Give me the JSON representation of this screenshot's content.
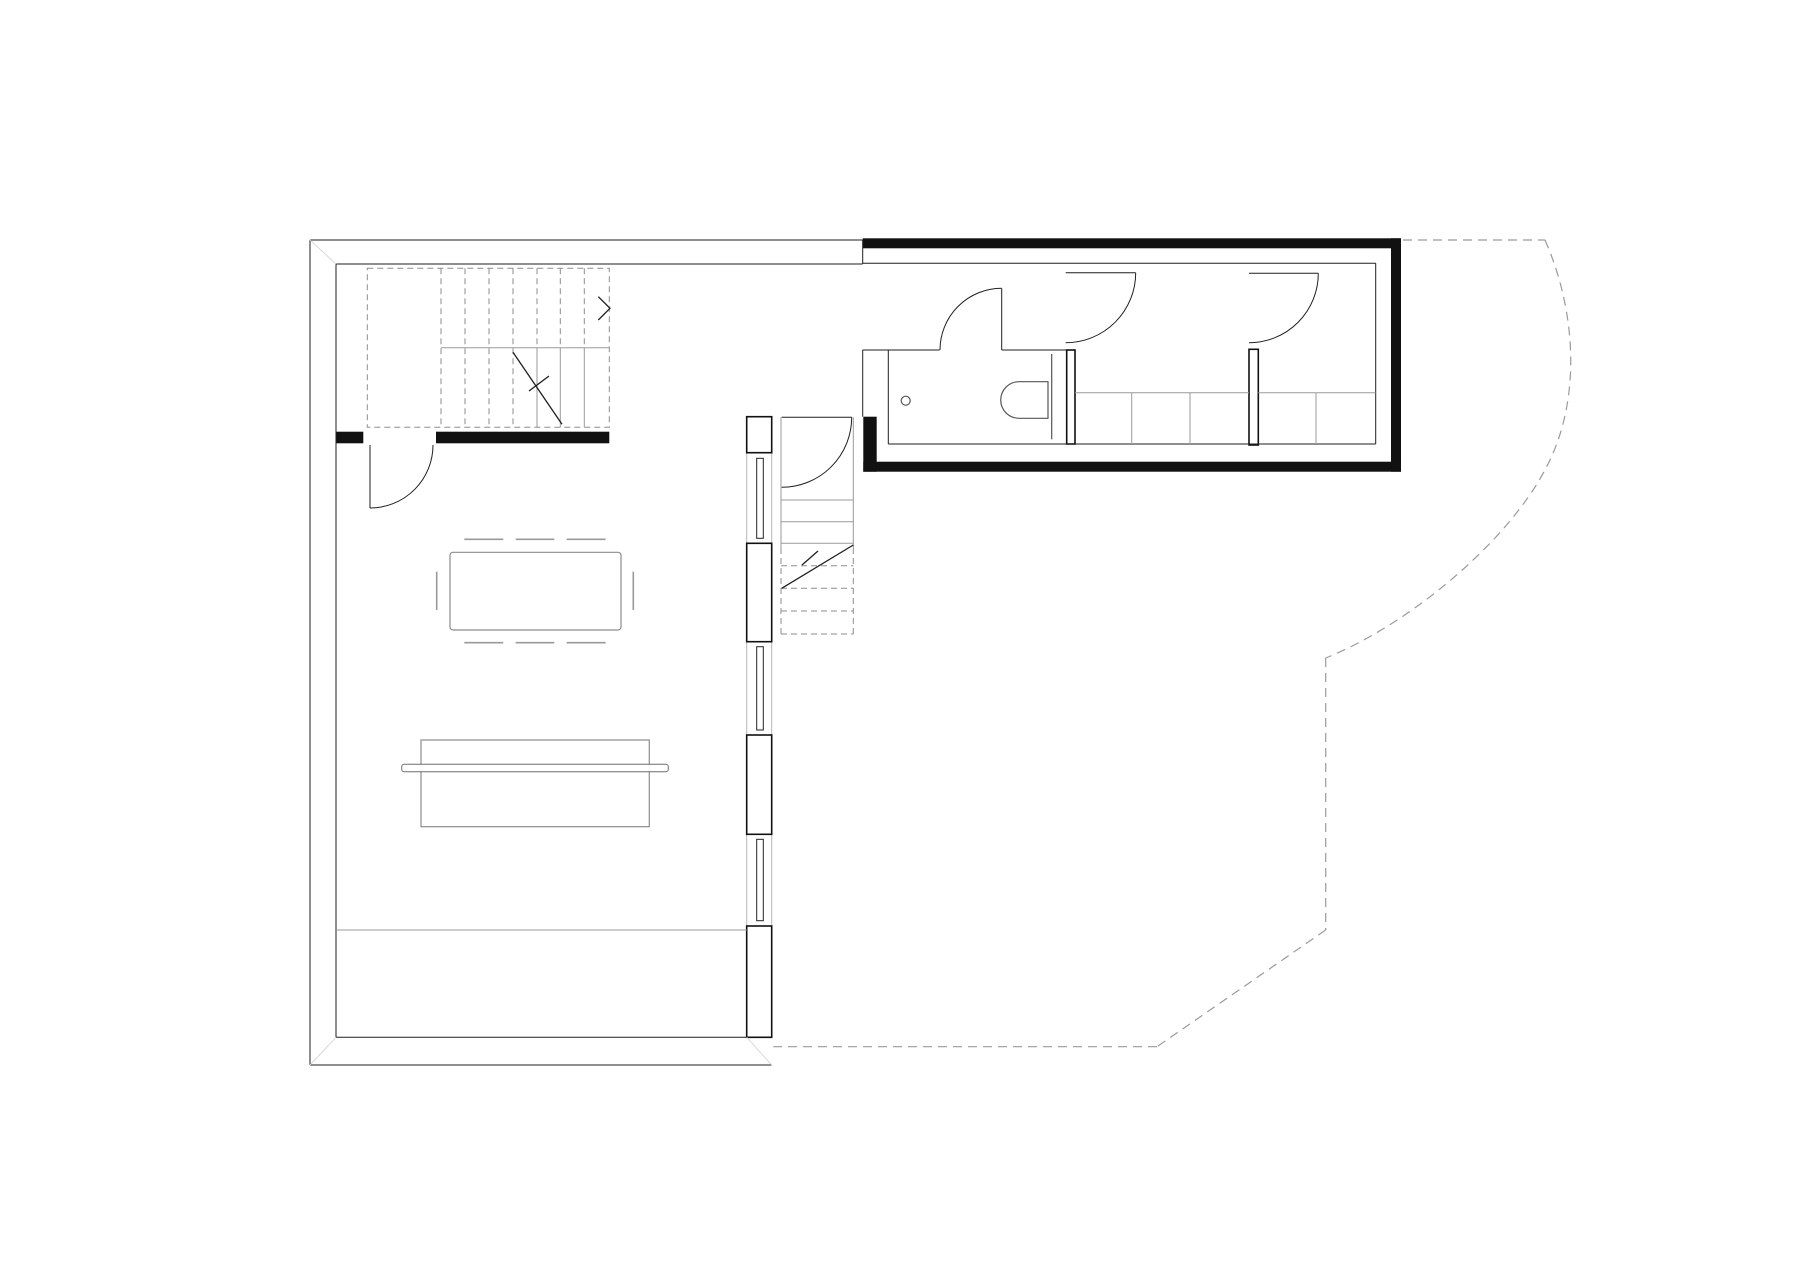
{
  "meta": {
    "title": "architectural-floor-plan",
    "canvas": {
      "w": 1800,
      "h": 1273
    },
    "background": "#ffffff"
  },
  "styles": {
    "wall": {
      "stroke": "#1f1f1f",
      "width": 1,
      "fill": "none"
    },
    "wallbold": {
      "stroke": "#111111",
      "width": 1.6,
      "fill": "#ffffff"
    },
    "black": {
      "stroke": "none",
      "width": 0,
      "fill": "#111111"
    },
    "band": {
      "stroke": "#b5b5b5",
      "width": 1,
      "fill": "none"
    },
    "glz": {
      "stroke": "#222222",
      "width": 1,
      "fill": "#ffffff"
    },
    "gray": {
      "stroke": "#9a9a9a",
      "width": 1,
      "fill": "none"
    },
    "graydash": {
      "stroke": "#8d8d8d",
      "width": 1,
      "fill": "none",
      "dash": "6,4"
    },
    "furn": {
      "stroke": "#8c8c8c",
      "width": 1.2,
      "fill": "#ffffff"
    },
    "furnbar": {
      "stroke": "#6f6f6f",
      "width": 1,
      "fill": "#ffffff"
    },
    "fix": {
      "stroke": "#555555",
      "width": 1.2,
      "fill": "#ffffff"
    },
    "mark": {
      "stroke": "#1f1f1f",
      "width": 1.3,
      "fill": "none"
    },
    "chair": {
      "stroke": "#9a9a9a",
      "width": 1.6,
      "fill": "none"
    },
    "site": {
      "stroke": "#9a9a9a",
      "width": 1.2,
      "fill": "none",
      "dash": "9,6"
    },
    "miter": {
      "stroke": "#d9d9d9",
      "width": 1,
      "fill": "none"
    }
  },
  "plan": {
    "rects": [
      {
        "name": "right-wall-band",
        "style": "band",
        "x": 746.7,
        "y": 416.7,
        "w": 25,
        "h": 620.6
      },
      {
        "name": "stair-up-boundary",
        "style": "graydash",
        "x": 367.3,
        "y": 268.3,
        "w": 242,
        "h": 159
      },
      {
        "name": "mullion-post-1",
        "style": "wallbold",
        "x": 746.7,
        "y": 416.7,
        "w": 25,
        "h": 36
      },
      {
        "name": "mullion-post-2",
        "style": "wallbold",
        "x": 746.7,
        "y": 543.3,
        "w": 25,
        "h": 98.4
      },
      {
        "name": "mullion-post-3",
        "style": "wallbold",
        "x": 746.7,
        "y": 735,
        "w": 25,
        "h": 99.3
      },
      {
        "name": "right-wall-solid",
        "style": "wallbold",
        "x": 746.7,
        "y": 926,
        "w": 25,
        "h": 111.3
      },
      {
        "name": "window-glazing-1",
        "style": "glz",
        "x": 756.7,
        "y": 458.3,
        "w": 6.6,
        "h": 80
      },
      {
        "name": "window-glazing-2",
        "style": "glz",
        "x": 756.7,
        "y": 646.7,
        "w": 6.6,
        "h": 83.3
      },
      {
        "name": "window-glazing-3",
        "style": "glz",
        "x": 756.7,
        "y": 839.3,
        "w": 6.6,
        "h": 81.4
      },
      {
        "name": "interior-wall-black",
        "style": "black",
        "x": 436,
        "y": 431.7,
        "w": 173.3,
        "h": 11.6
      },
      {
        "name": "interior-wall-stub",
        "style": "black",
        "x": 336,
        "y": 431.7,
        "w": 27.3,
        "h": 11.6
      },
      {
        "name": "volume-wall-top",
        "style": "black",
        "x": 862.7,
        "y": 238.3,
        "w": 538.3,
        "h": 10
      },
      {
        "name": "volume-wall-right",
        "style": "black",
        "x": 1391,
        "y": 238.3,
        "w": 10,
        "h": 233.4
      },
      {
        "name": "volume-wall-bottom",
        "style": "black",
        "x": 863.3,
        "y": 461.7,
        "w": 537.7,
        "h": 10
      },
      {
        "name": "volume-wall-left-stub",
        "style": "black",
        "x": 863.3,
        "y": 416.7,
        "w": 13.4,
        "h": 55
      },
      {
        "name": "closet-partition-1",
        "style": "wallbold",
        "x": 1066.7,
        "y": 350,
        "w": 8.3,
        "h": 94
      },
      {
        "name": "closet-partition-2",
        "style": "wallbold",
        "x": 1249,
        "y": 349.3,
        "w": 9.3,
        "h": 95.7
      },
      {
        "name": "dining-table",
        "style": "furn",
        "x": 450,
        "y": 552.3,
        "w": 171,
        "h": 77.7,
        "rx": 3
      },
      {
        "name": "sofa-bench",
        "style": "furn",
        "x": 421,
        "y": 740,
        "w": 228.3,
        "h": 86.7
      },
      {
        "name": "sofa-backrest-bar",
        "style": "furnbar",
        "x": 401.7,
        "y": 764.3,
        "w": 266.6,
        "h": 7.4,
        "rx": 2.5
      }
    ],
    "lines": [
      {
        "name": "outer-wall-top",
        "style": "wall",
        "x1": 310,
        "y1": 240,
        "x2": 862.7,
        "y2": 240
      },
      {
        "name": "inner-wall-top",
        "style": "wall",
        "x1": 336,
        "y1": 264,
        "x2": 862.7,
        "y2": 264
      },
      {
        "name": "top-wall-end-cap",
        "style": "wall",
        "x1": 862.7,
        "y1": 240,
        "x2": 862.7,
        "y2": 264
      },
      {
        "name": "outer-wall-left",
        "style": "wall",
        "x1": 310,
        "y1": 240,
        "x2": 310,
        "y2": 1065
      },
      {
        "name": "inner-wall-left",
        "style": "wall",
        "x1": 336,
        "y1": 264,
        "x2": 336,
        "y2": 1037.3
      },
      {
        "name": "outer-wall-bottom",
        "style": "wall",
        "x1": 310,
        "y1": 1065,
        "x2": 771.7,
        "y2": 1065
      },
      {
        "name": "inner-wall-bottom",
        "style": "wall",
        "x1": 336,
        "y1": 1037.3,
        "x2": 746.7,
        "y2": 1037.3
      },
      {
        "name": "miter-top-left",
        "style": "miter",
        "x1": 310,
        "y1": 240,
        "x2": 336,
        "y2": 264
      },
      {
        "name": "miter-bottom-left",
        "style": "miter",
        "x1": 310,
        "y1": 1065,
        "x2": 336,
        "y2": 1037.3
      },
      {
        "name": "miter-bottom-right",
        "style": "miter",
        "x1": 746.7,
        "y1": 1037.3,
        "x2": 771.7,
        "y2": 1065
      },
      {
        "name": "terrace-edge-line",
        "style": "gray",
        "x1": 336,
        "y1": 930,
        "x2": 746.7,
        "y2": 930
      },
      {
        "name": "volume-ceiling-face",
        "style": "wall",
        "x1": 862.7,
        "y1": 263.3,
        "x2": 1375.7,
        "y2": 263.3
      },
      {
        "name": "volume-right-face",
        "style": "wall",
        "x1": 1375.7,
        "y1": 263.3,
        "x2": 1375.7,
        "y2": 444
      },
      {
        "name": "volume-bottom-face",
        "style": "wall",
        "x1": 888.3,
        "y1": 444,
        "x2": 1375.7,
        "y2": 444
      },
      {
        "name": "bath-wall-top-left",
        "style": "wall",
        "x1": 862.7,
        "y1": 350,
        "x2": 939.7,
        "y2": 350
      },
      {
        "name": "bath-wall-top-right",
        "style": "wall",
        "x1": 1001.7,
        "y1": 350,
        "x2": 1066.7,
        "y2": 350
      },
      {
        "name": "bath-wall-left-inner",
        "style": "wall",
        "x1": 888.3,
        "y1": 350,
        "x2": 888.3,
        "y2": 444
      },
      {
        "name": "bath-wall-left-outer",
        "style": "wall",
        "x1": 862.7,
        "y1": 350,
        "x2": 862.7,
        "y2": 416.7
      },
      {
        "name": "wc-mounting-wall",
        "style": "fix",
        "x1": 1051.7,
        "y1": 354,
        "x2": 1051.7,
        "y2": 439.3
      },
      {
        "name": "bath-door-leaf",
        "style": "wall",
        "x1": 1001.7,
        "y1": 288.3,
        "x2": 1001.7,
        "y2": 350
      },
      {
        "name": "room2-door-leaf",
        "style": "wall",
        "x1": 1065.7,
        "y1": 272.7,
        "x2": 1135.7,
        "y2": 272.7
      },
      {
        "name": "room3-door-leaf",
        "style": "wall",
        "x1": 1249,
        "y1": 273.3,
        "x2": 1318.3,
        "y2": 273.3
      },
      {
        "name": "stairwell-door-leaf",
        "style": "wall",
        "x1": 781.7,
        "y1": 417.3,
        "x2": 851.7,
        "y2": 417.3
      },
      {
        "name": "entry-door-leaf",
        "style": "wall",
        "x1": 370,
        "y1": 445,
        "x2": 370,
        "y2": 508
      },
      {
        "name": "closet-front-left",
        "style": "gray",
        "x1": 1075,
        "y1": 392.7,
        "x2": 1249,
        "y2": 392.7
      },
      {
        "name": "closet-front-right",
        "style": "gray",
        "x1": 1258.3,
        "y1": 392.7,
        "x2": 1375.7,
        "y2": 392.7
      },
      {
        "name": "closet-divider-1",
        "style": "gray",
        "x1": 1131.7,
        "y1": 392.7,
        "x2": 1131.7,
        "y2": 444
      },
      {
        "name": "closet-divider-2",
        "style": "gray",
        "x1": 1190,
        "y1": 392.7,
        "x2": 1190,
        "y2": 444
      },
      {
        "name": "closet-divider-3",
        "style": "gray",
        "x1": 1316,
        "y1": 392.7,
        "x2": 1316,
        "y2": 444
      },
      {
        "name": "stair-up-tread-1",
        "style": "graydash",
        "x1": 441,
        "y1": 268.3,
        "x2": 441,
        "y2": 427.3
      },
      {
        "name": "stair-up-tread-2",
        "style": "graydash",
        "x1": 465,
        "y1": 268.3,
        "x2": 465,
        "y2": 427.3
      },
      {
        "name": "stair-up-tread-3",
        "style": "graydash",
        "x1": 489,
        "y1": 268.3,
        "x2": 489,
        "y2": 427.3
      },
      {
        "name": "stair-up-tread-4",
        "style": "graydash",
        "x1": 513,
        "y1": 268.3,
        "x2": 513,
        "y2": 427.3
      },
      {
        "name": "stair-up-tread-5-upper",
        "style": "graydash",
        "x1": 537,
        "y1": 268.3,
        "x2": 537,
        "y2": 347.7
      },
      {
        "name": "stair-up-tread-6-upper",
        "style": "graydash",
        "x1": 560.3,
        "y1": 268.3,
        "x2": 560.3,
        "y2": 347.7
      },
      {
        "name": "stair-up-tread-7-upper",
        "style": "graydash",
        "x1": 584.3,
        "y1": 268.3,
        "x2": 584.3,
        "y2": 347.7
      },
      {
        "name": "stair-up-tread-5-lower",
        "style": "gray",
        "x1": 537,
        "y1": 347.7,
        "x2": 537,
        "y2": 427.3
      },
      {
        "name": "stair-up-tread-6-lower",
        "style": "gray",
        "x1": 560.3,
        "y1": 347.7,
        "x2": 560.3,
        "y2": 427.3
      },
      {
        "name": "stair-up-tread-7-lower",
        "style": "gray",
        "x1": 584.3,
        "y1": 347.7,
        "x2": 584.3,
        "y2": 427.3
      },
      {
        "name": "stair-up-break-line",
        "style": "gray",
        "x1": 441,
        "y1": 347.7,
        "x2": 609.3,
        "y2": 347.7
      },
      {
        "name": "stair-up-cut-diagonal",
        "style": "mark",
        "x1": 513,
        "y1": 352.3,
        "x2": 562,
        "y2": 424.3
      },
      {
        "name": "stair-up-cut-tick",
        "style": "mark",
        "x1": 549,
        "y1": 376,
        "x2": 529,
        "y2": 391
      },
      {
        "name": "stair-down-edge-left",
        "style": "gray",
        "x1": 781,
        "y1": 417.3,
        "x2": 781,
        "y2": 548
      },
      {
        "name": "stair-down-edge-right",
        "style": "gray",
        "x1": 853.3,
        "y1": 417.3,
        "x2": 853.3,
        "y2": 548
      },
      {
        "name": "stair-down-edge-left-d",
        "style": "graydash",
        "x1": 781,
        "y1": 548,
        "x2": 781,
        "y2": 634
      },
      {
        "name": "stair-down-edge-right-d",
        "style": "graydash",
        "x1": 853.3,
        "y1": 548,
        "x2": 853.3,
        "y2": 634
      },
      {
        "name": "stair-down-tread-1",
        "style": "gray",
        "x1": 781,
        "y1": 500,
        "x2": 853.3,
        "y2": 500
      },
      {
        "name": "stair-down-tread-2",
        "style": "gray",
        "x1": 781,
        "y1": 521.7,
        "x2": 853.3,
        "y2": 521.7
      },
      {
        "name": "stair-down-tread-3",
        "style": "gray",
        "x1": 781,
        "y1": 543.3,
        "x2": 853.3,
        "y2": 543.3
      },
      {
        "name": "stair-down-tread-4",
        "style": "graydash",
        "x1": 781,
        "y1": 565.7,
        "x2": 853.3,
        "y2": 565.7
      },
      {
        "name": "stair-down-tread-5",
        "style": "graydash",
        "x1": 781,
        "y1": 588.3,
        "x2": 853.3,
        "y2": 588.3
      },
      {
        "name": "stair-down-tread-6",
        "style": "graydash",
        "x1": 781,
        "y1": 611,
        "x2": 853.3,
        "y2": 611
      },
      {
        "name": "stair-down-tread-7",
        "style": "graydash",
        "x1": 781,
        "y1": 634,
        "x2": 853.3,
        "y2": 634
      },
      {
        "name": "stair-down-cut-diagonal",
        "style": "mark",
        "x1": 781.7,
        "y1": 588.3,
        "x2": 853.3,
        "y2": 545
      },
      {
        "name": "stair-down-cut-tick",
        "style": "mark",
        "x1": 818,
        "y1": 551,
        "x2": 802,
        "y2": 565
      },
      {
        "name": "chair-mark-top-1",
        "style": "chair",
        "x1": 464.3,
        "y1": 539.3,
        "x2": 503.3,
        "y2": 539.3
      },
      {
        "name": "chair-mark-top-2",
        "style": "chair",
        "x1": 515.7,
        "y1": 539.3,
        "x2": 554.3,
        "y2": 539.3
      },
      {
        "name": "chair-mark-top-3",
        "style": "chair",
        "x1": 566.7,
        "y1": 539.3,
        "x2": 605.7,
        "y2": 539.3
      },
      {
        "name": "chair-mark-bottom-1",
        "style": "chair",
        "x1": 464.3,
        "y1": 642.7,
        "x2": 503.3,
        "y2": 642.7
      },
      {
        "name": "chair-mark-bottom-2",
        "style": "chair",
        "x1": 515.7,
        "y1": 642.7,
        "x2": 554.3,
        "y2": 642.7
      },
      {
        "name": "chair-mark-bottom-3",
        "style": "chair",
        "x1": 566.7,
        "y1": 642.7,
        "x2": 605.7,
        "y2": 642.7
      },
      {
        "name": "chair-mark-left",
        "style": "chair",
        "x1": 436.7,
        "y1": 571.7,
        "x2": 436.7,
        "y2": 610
      },
      {
        "name": "chair-mark-right",
        "style": "chair",
        "x1": 633.3,
        "y1": 571.7,
        "x2": 633.3,
        "y2": 610
      },
      {
        "name": "site-boundary-top",
        "style": "site",
        "x1": 1403,
        "y1": 240,
        "x2": 1545,
        "y2": 240
      },
      {
        "name": "site-boundary-vertical",
        "style": "site",
        "x1": 1325.7,
        "y1": 658,
        "x2": 1325.7,
        "y2": 930
      },
      {
        "name": "site-boundary-diagonal",
        "style": "site",
        "x1": 1325.7,
        "y1": 930,
        "x2": 1157,
        "y2": 1046.7
      },
      {
        "name": "site-boundary-bottom",
        "style": "site",
        "x1": 1157,
        "y1": 1046.7,
        "x2": 773.3,
        "y2": 1046.7
      }
    ],
    "paths": [
      {
        "name": "site-boundary-curve",
        "style": "site",
        "d": "M 1545,240 C 1575,308 1583,398 1546,468 C 1506,545 1406,626 1325.7,658"
      },
      {
        "name": "entry-door-swing",
        "style": "wall",
        "d": "M 370,508 A 63,63 0 0 0 433,445"
      },
      {
        "name": "bath-door-swing",
        "style": "wall",
        "d": "M 1001.7,288.3 A 61.7,61.7 0 0 0 940,350"
      },
      {
        "name": "room2-door-swing",
        "style": "wall",
        "d": "M 1135.7,272.7 A 70,70 0 0 1 1065.7,342.7"
      },
      {
        "name": "room3-door-swing",
        "style": "wall",
        "d": "M 1318.3,273.3 A 69.3,69.3 0 0 1 1249,342.7"
      },
      {
        "name": "stairwell-door-swing",
        "style": "wall",
        "d": "M 851.7,417.3 A 70,70 0 0 1 781.7,487.3"
      },
      {
        "name": "toilet-bowl",
        "style": "fix",
        "d": "M 1048,381.7 L 1019,381.7 A 18.3,18.3 0 0 0 1019,418.3 L 1048,418.3 Z"
      }
    ],
    "polylines": [
      {
        "name": "stair-up-direction-arrow",
        "style": "mark",
        "points": "598.3,296.7 610,308.3 598.3,320"
      }
    ],
    "circles": [
      {
        "name": "floor-drain",
        "style": "fix",
        "cx": 905.7,
        "cy": 400.7,
        "r": 4.5
      }
    ]
  }
}
